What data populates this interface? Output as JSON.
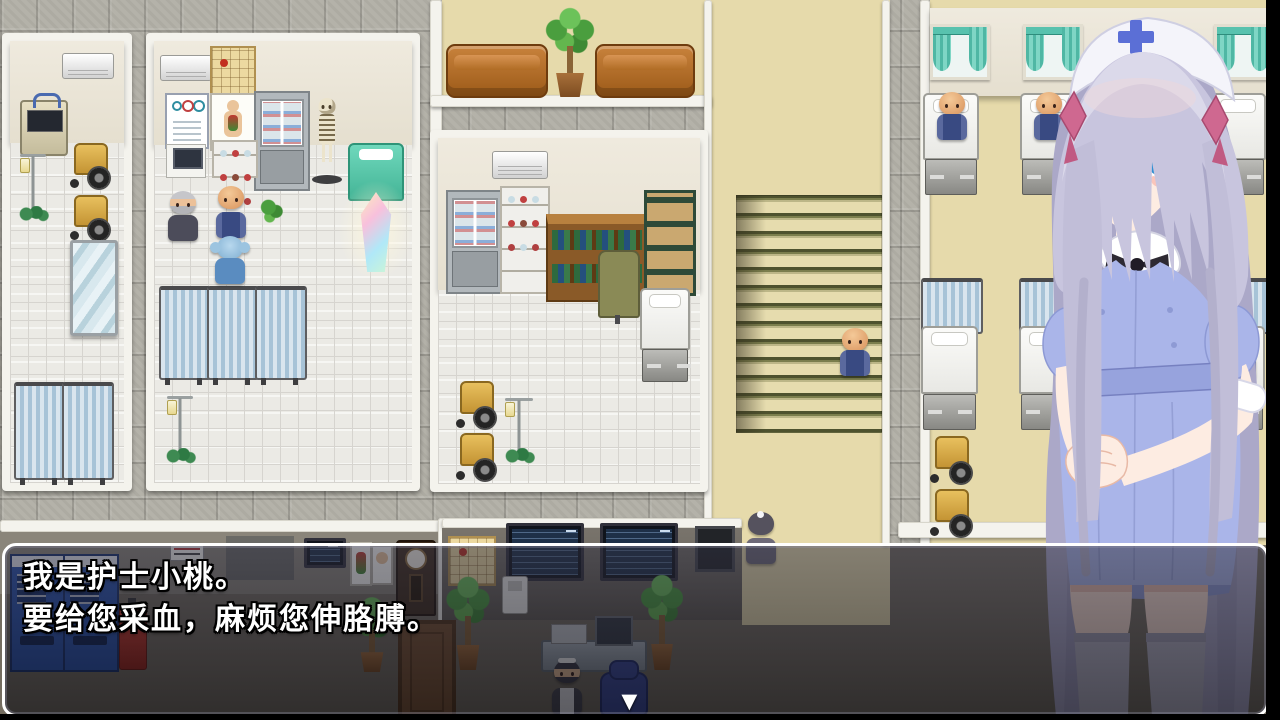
{
  "dialogue": {
    "line1": "我是护士小桃。",
    "line2": "要给您采血，麻烦您伸胳膊。",
    "continue_glyph": "▼"
  },
  "scene": {
    "location": "hospital-interior-map",
    "npcs": [
      "nurse-portrait",
      "doctor",
      "bald-patient",
      "player-girl",
      "maid-receptionist",
      "maid-walking",
      "elderly-woman",
      "ward-patient-1",
      "ward-patient-2",
      "ward-patient-3",
      "patient-on-stairs"
    ],
    "objects": [
      "sofa",
      "potted-plant",
      "stairs",
      "hospital-bed",
      "privacy-screen",
      "wheelchair",
      "iv-stand",
      "skeleton-model",
      "exam-bed",
      "healing-crystal",
      "eye-chart",
      "anatomy-poster",
      "wall-calendar",
      "medicine-cabinet",
      "bookshelf",
      "storage-rack",
      "vending-machine",
      "fire-extinguisher",
      "grandfather-clock",
      "door",
      "tv-monitor",
      "reception-desk",
      "office-chair",
      "window-with-curtains",
      "air-conditioner",
      "mirror",
      "telephone"
    ]
  },
  "colors": {
    "hall_tile": "#b4b2a9",
    "room_floor": "#ebeae5",
    "corridor_floor": "#e6daab",
    "stair_stripe": "#4e522e",
    "wall_cream": "#eae5d7",
    "trim_white": "#f4f3ed",
    "curtain_teal": "#68c9b7",
    "privacy_screen_blue": "#cfdfeb",
    "couch_brown": "#b06a24",
    "dialogue_border": "#ffffff",
    "dialogue_text": "#ffffff",
    "nurse_hair": "#c6c3dc",
    "nurse_dress": "#aab5e9",
    "nurse_eyes": "#2f8fd2"
  }
}
